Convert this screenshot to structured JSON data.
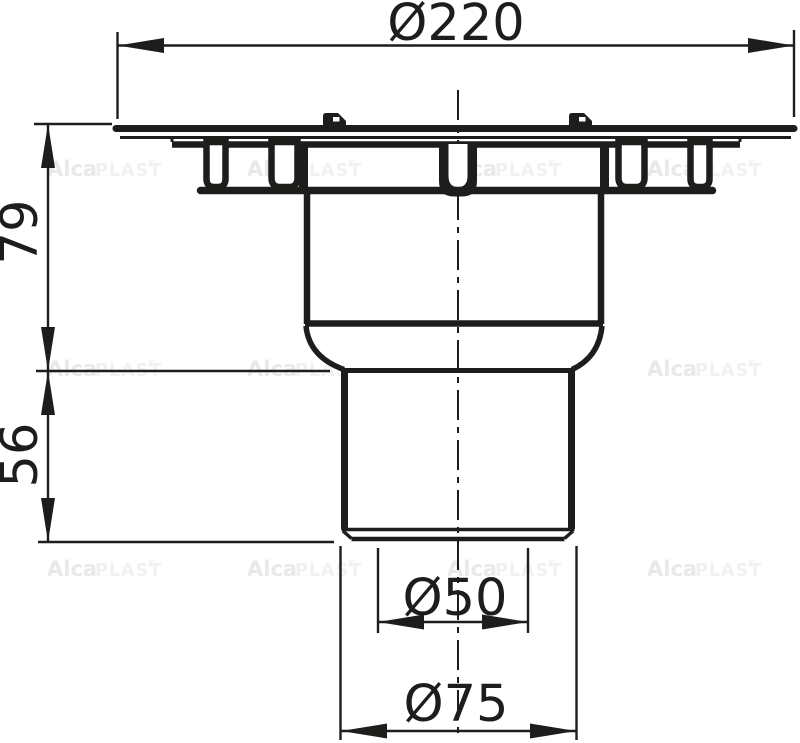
{
  "drawing": {
    "line_color": "#1d1d1b",
    "background_color": "#ffffff"
  },
  "dimensions": {
    "top_diameter": "Ø220",
    "body_height": "79",
    "outlet_length": "56",
    "outlet_inner_diameter": "Ø50",
    "outlet_outer_diameter": "Ø75"
  },
  "watermark": {
    "brand_bold": "Alca",
    "brand_light": "PLAST",
    "reg_mark": "®",
    "color_bold": "#e9e9e9",
    "color_light": "#f1f1f1"
  }
}
